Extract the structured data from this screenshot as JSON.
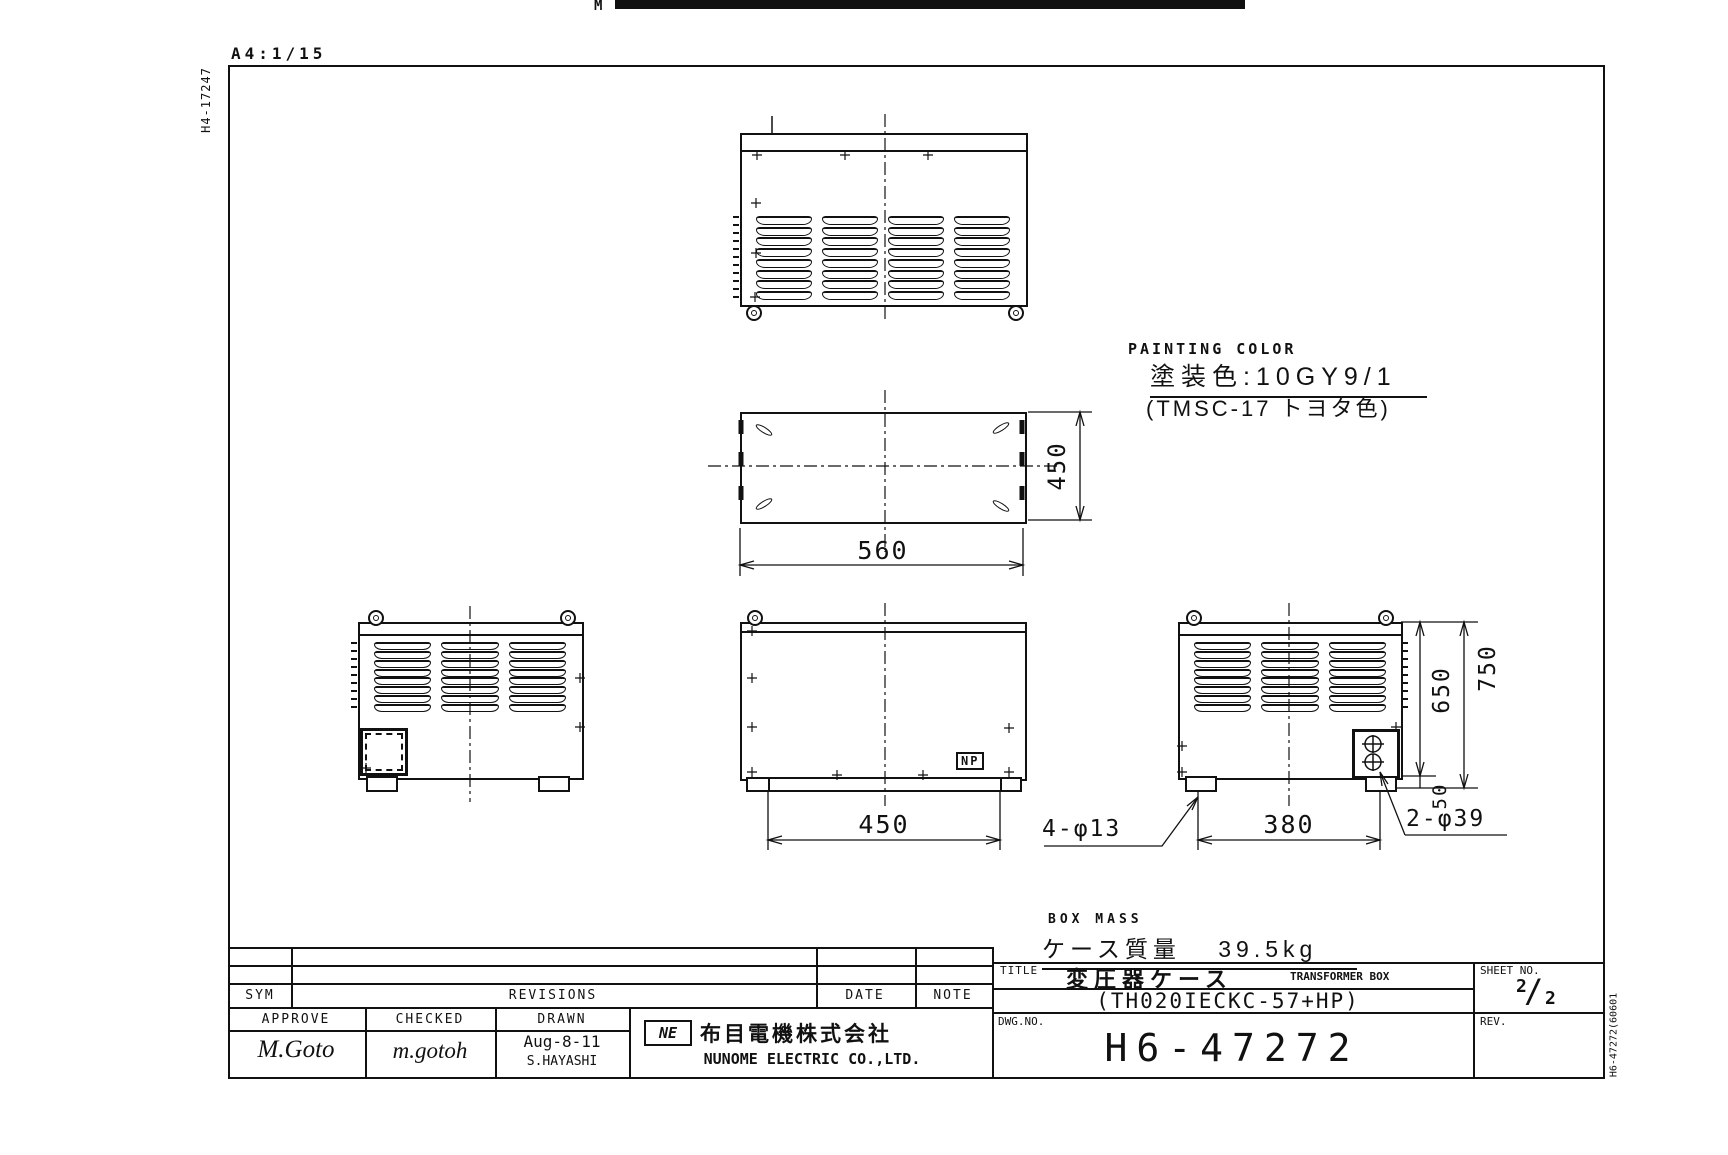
{
  "page": {
    "corner_label": "A4:1/15",
    "left_code": "H4-17247",
    "right_code": "H6-47272(60601",
    "scan_fragment": "M"
  },
  "painting": {
    "label": "PAINTING COLOR",
    "value": "塗装色:10GY9/1",
    "note": "(TMSC-17 トヨタ色)"
  },
  "mass": {
    "label": "BOX MASS",
    "value": "ケース質量 39.5kg"
  },
  "nameplate": "NP",
  "dims": {
    "plan_width": "560",
    "plan_depth": "450",
    "front_bolt_span": "450",
    "side_bolt_span": "380",
    "body_height": "650",
    "overall_height": "750",
    "base_height": "50",
    "base_holes": "4-φ13",
    "gland_holes": "2-φ39"
  },
  "title_block": {
    "sym": "SYM",
    "revisions": "REVISIONS",
    "date": "DATE",
    "note": "NOTE",
    "approve": "APPROVE",
    "checked": "CHECKED",
    "drawn": "DRAWN",
    "approve_sign": "M.Goto",
    "checked_sign": "m.gotoh",
    "drawn_date": "Aug-8-11",
    "drawn_name": "S.HAYASHI",
    "logo": "NE",
    "company_jp": "布目電機株式会社",
    "company_en": "NUNOME ELECTRIC CO.,LTD.",
    "title_label": "TITLE",
    "title_jp": "変圧器ケース",
    "title_en": "TRANSFORMER BOX",
    "model": "(TH020IECKC-57+HP)",
    "dwg_label": "DWG.NO.",
    "dwg_no": "H6-47272",
    "sheet_label": "SHEET NO.",
    "sheet_top": "2",
    "sheet_slash": "/",
    "sheet_bottom": "2",
    "rev_label": "REV."
  }
}
